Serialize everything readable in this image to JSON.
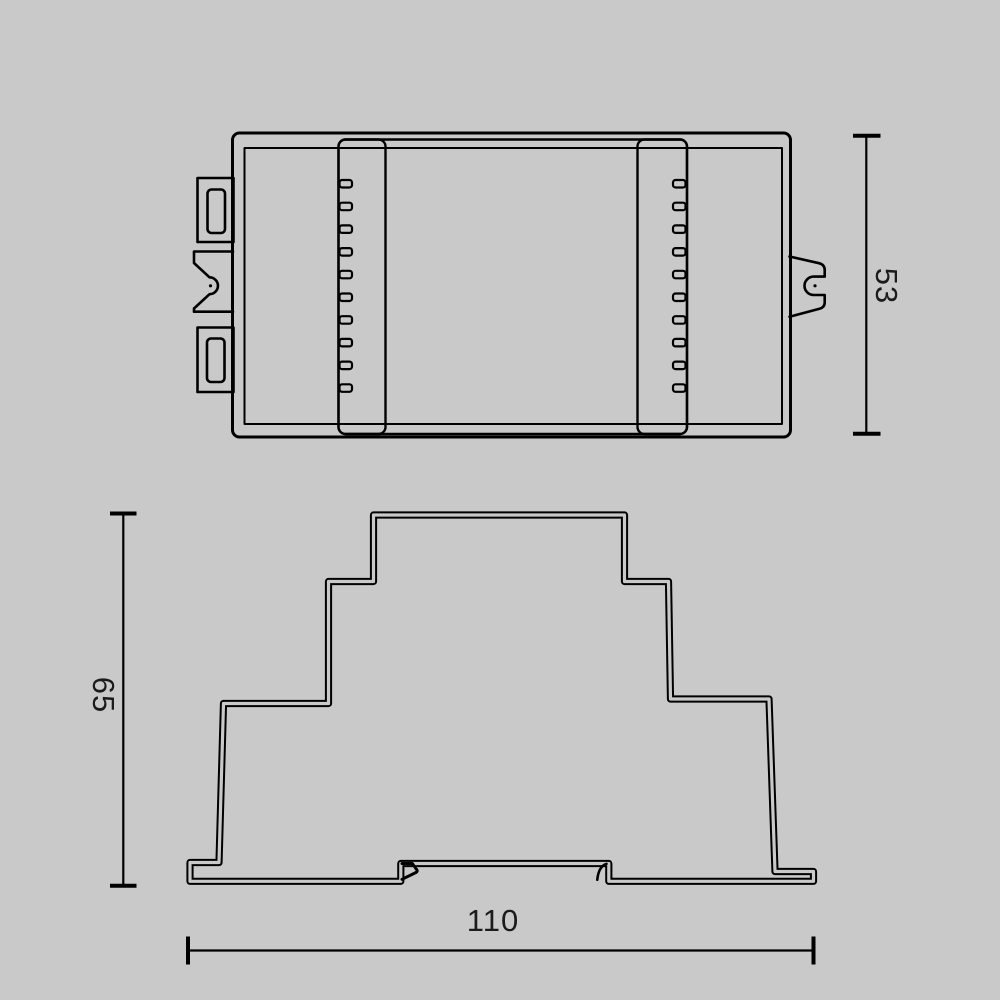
{
  "drawing": {
    "title": "technical-drawing-din-rail-module",
    "background_color": "#c9c9c9",
    "line_color": "#000000",
    "views": {
      "top_view": {
        "description": "device seen from above with terminal strips and mounting tabs",
        "ribs_per_strip": 10,
        "height_dimension": {
          "label": "53"
        }
      },
      "front_view": {
        "description": "stepped front profile with DIN rail feet",
        "height_dimension": {
          "label": "65"
        },
        "width_dimension": {
          "label": "110"
        }
      }
    }
  }
}
